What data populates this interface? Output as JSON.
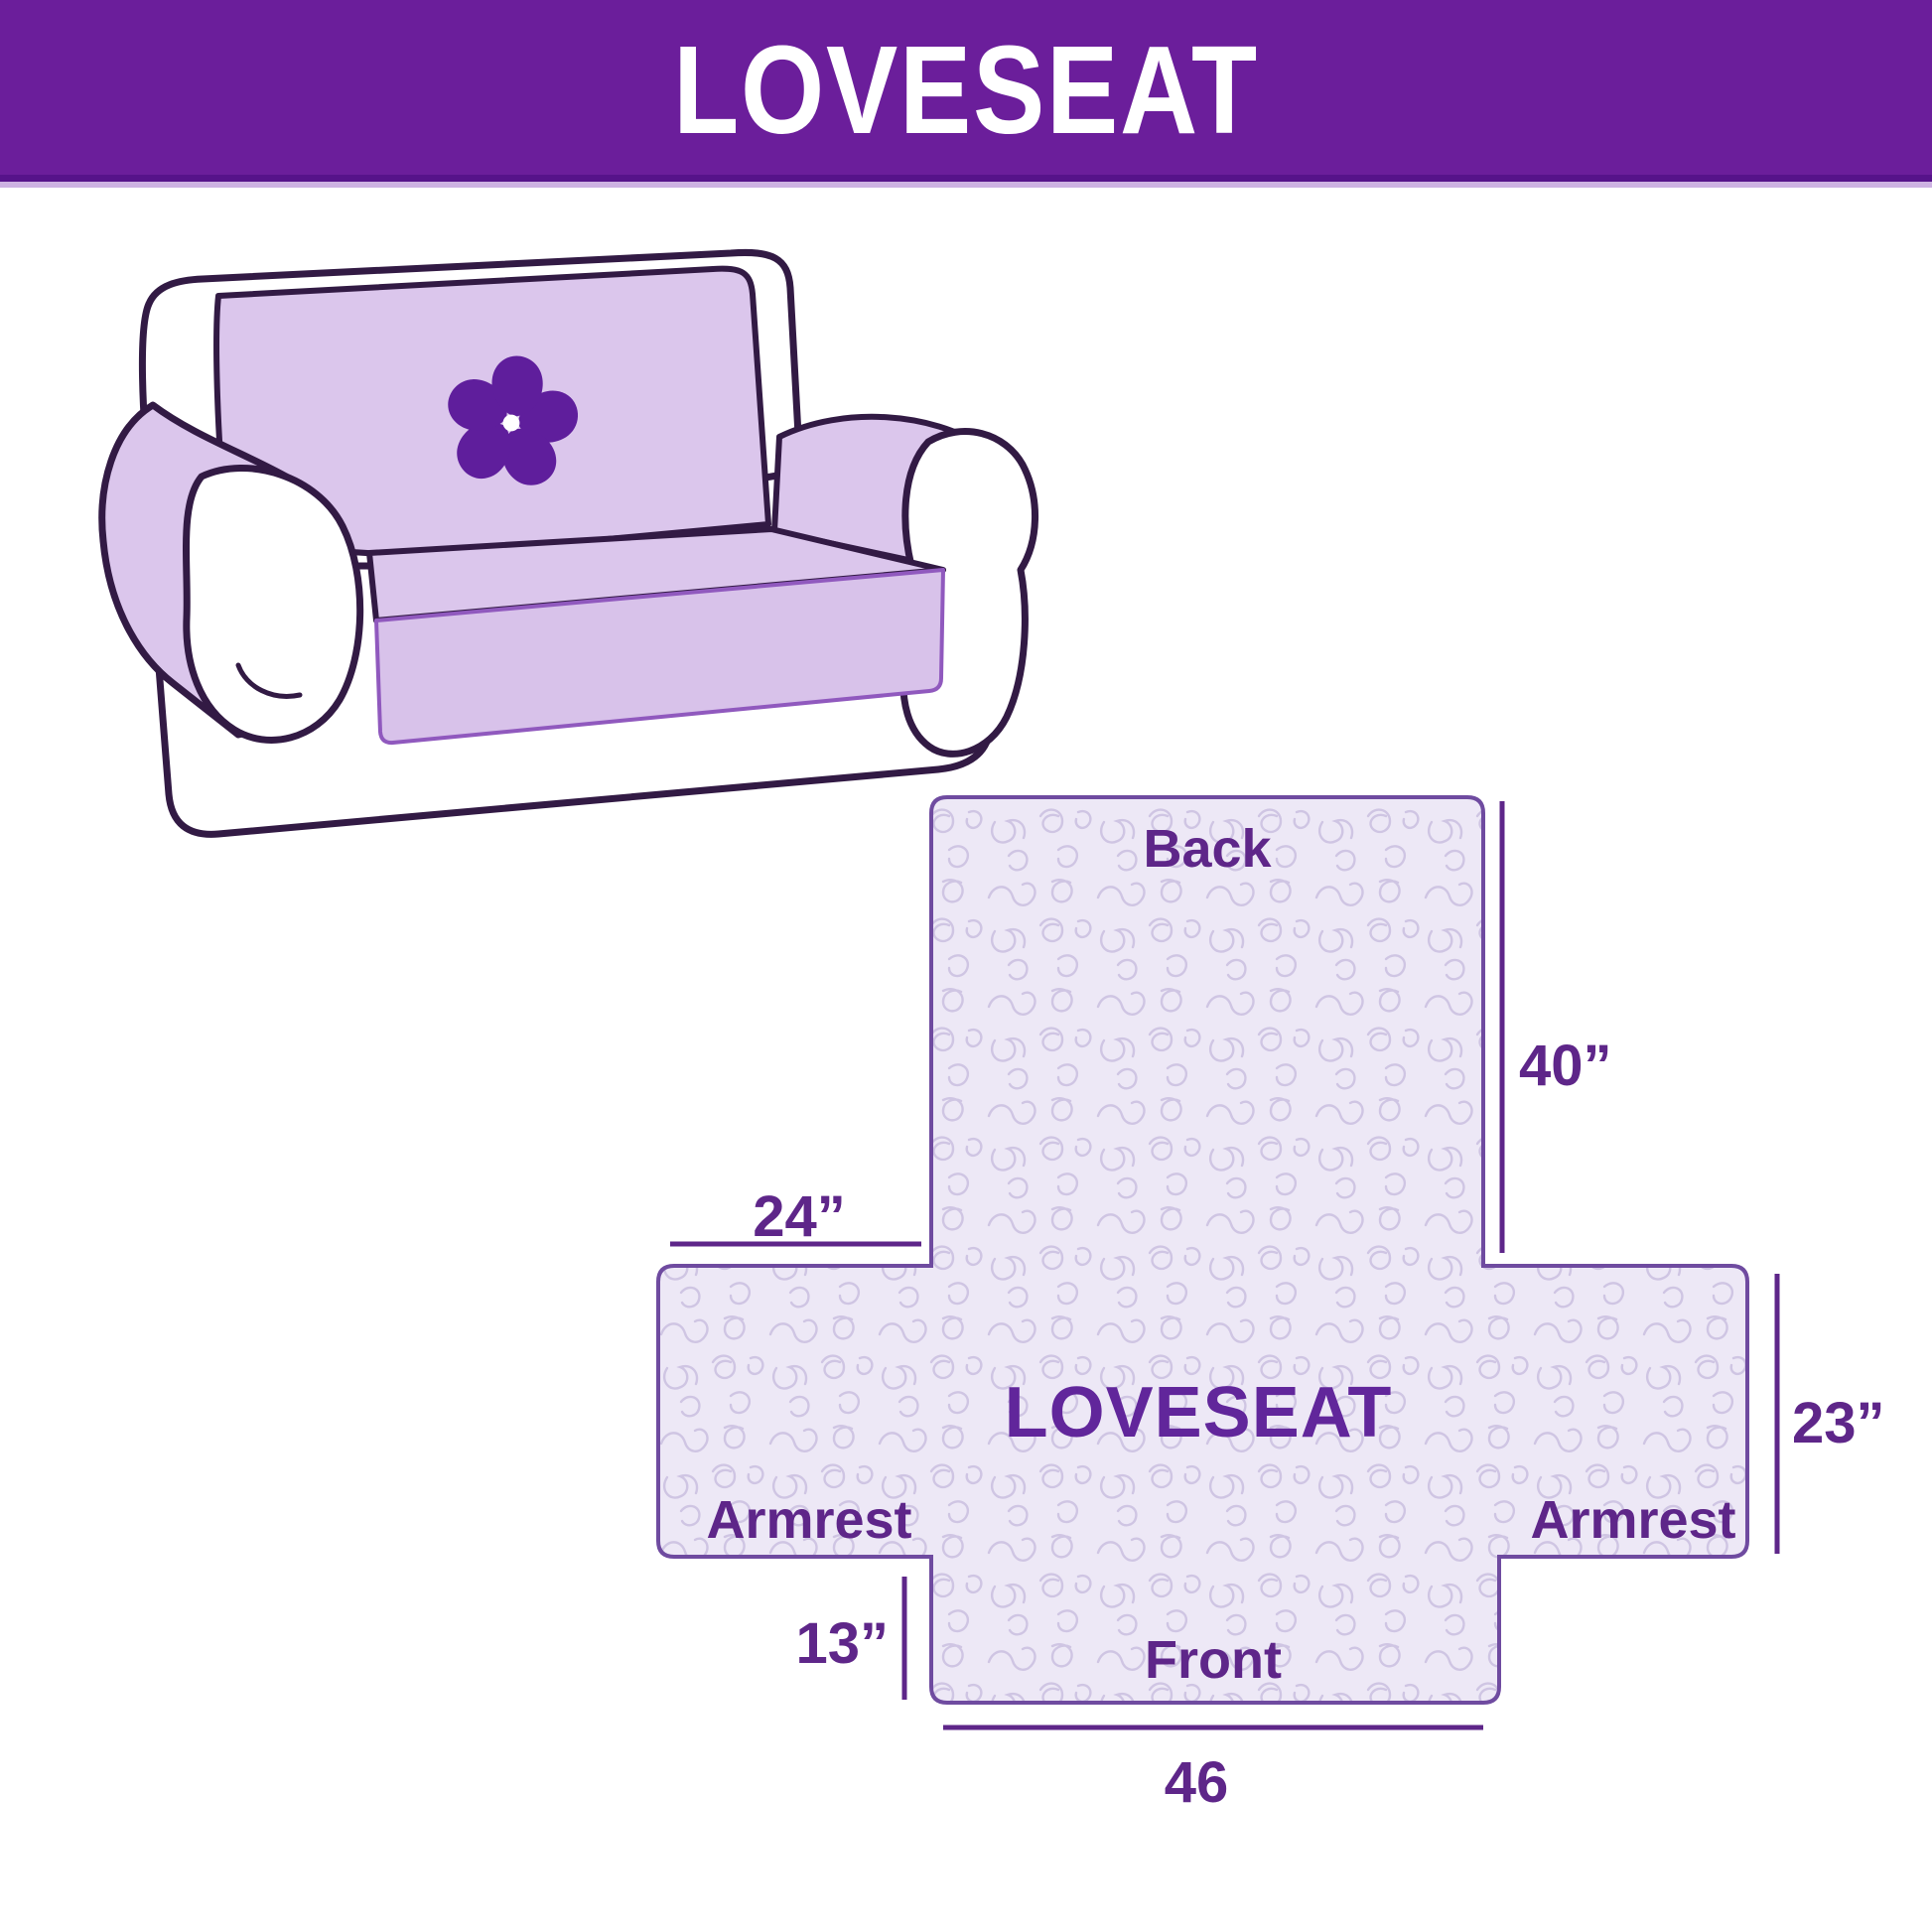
{
  "header": {
    "title": "LOVESEAT",
    "bg_color": "#6B1E9B",
    "text_color": "#FFFFFF"
  },
  "sofa": {
    "description": "loveseat sofa illustration with protective cover",
    "logo_icon": "pinwheel-flower-icon",
    "cover_color": "#DBC6EC",
    "outline_color": "#321A44",
    "logo_color": "#5F1E9C"
  },
  "diagram": {
    "title": "LOVESEAT",
    "labels": {
      "back": "Back",
      "front": "Front",
      "armrest_left": "Armrest",
      "armrest_right": "Armrest"
    },
    "dimensions": {
      "back_height": "40”",
      "armrest_width": "24”",
      "side_height": "23”",
      "front_height": "13”",
      "front_width": "46"
    },
    "fill_color": "#EDE8F6",
    "pattern_color": "#CFC5E3",
    "border_color": "#6F4BA0",
    "text_color": "#5E2689"
  }
}
